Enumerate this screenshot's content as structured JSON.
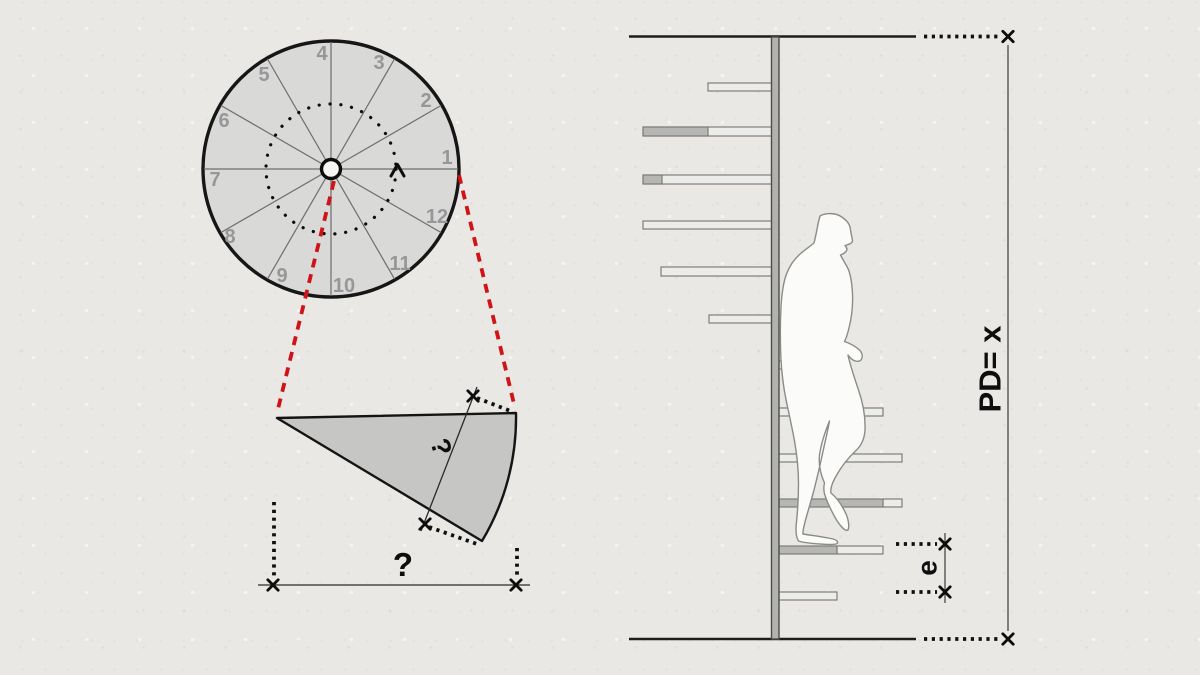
{
  "figure": {
    "type": "technical-diagram",
    "subject": "Spiral staircase: plan view, single tread detail and section with person"
  },
  "plan_view": {
    "sector_labels": [
      "1",
      "2",
      "3",
      "4",
      "5",
      "6",
      "7",
      "8",
      "9",
      "10",
      "11",
      "12"
    ],
    "direction_icon": "rotation-chevron-up"
  },
  "tread_detail": {
    "tread_depth_label": "?",
    "overall_width_label": "?"
  },
  "section_view": {
    "total_rise_label": "PD= x",
    "riser_height_label": "e"
  },
  "colors": {
    "background": "#e9e8e5",
    "plan_fill": "#d9d9d7",
    "wedge_fill": "#c6c6c4",
    "tread_light": "#ececea",
    "tread_dark": "#b6b6b4",
    "projection_red": "#d01318",
    "ink": "#121212",
    "label_gray": "#97979a"
  }
}
